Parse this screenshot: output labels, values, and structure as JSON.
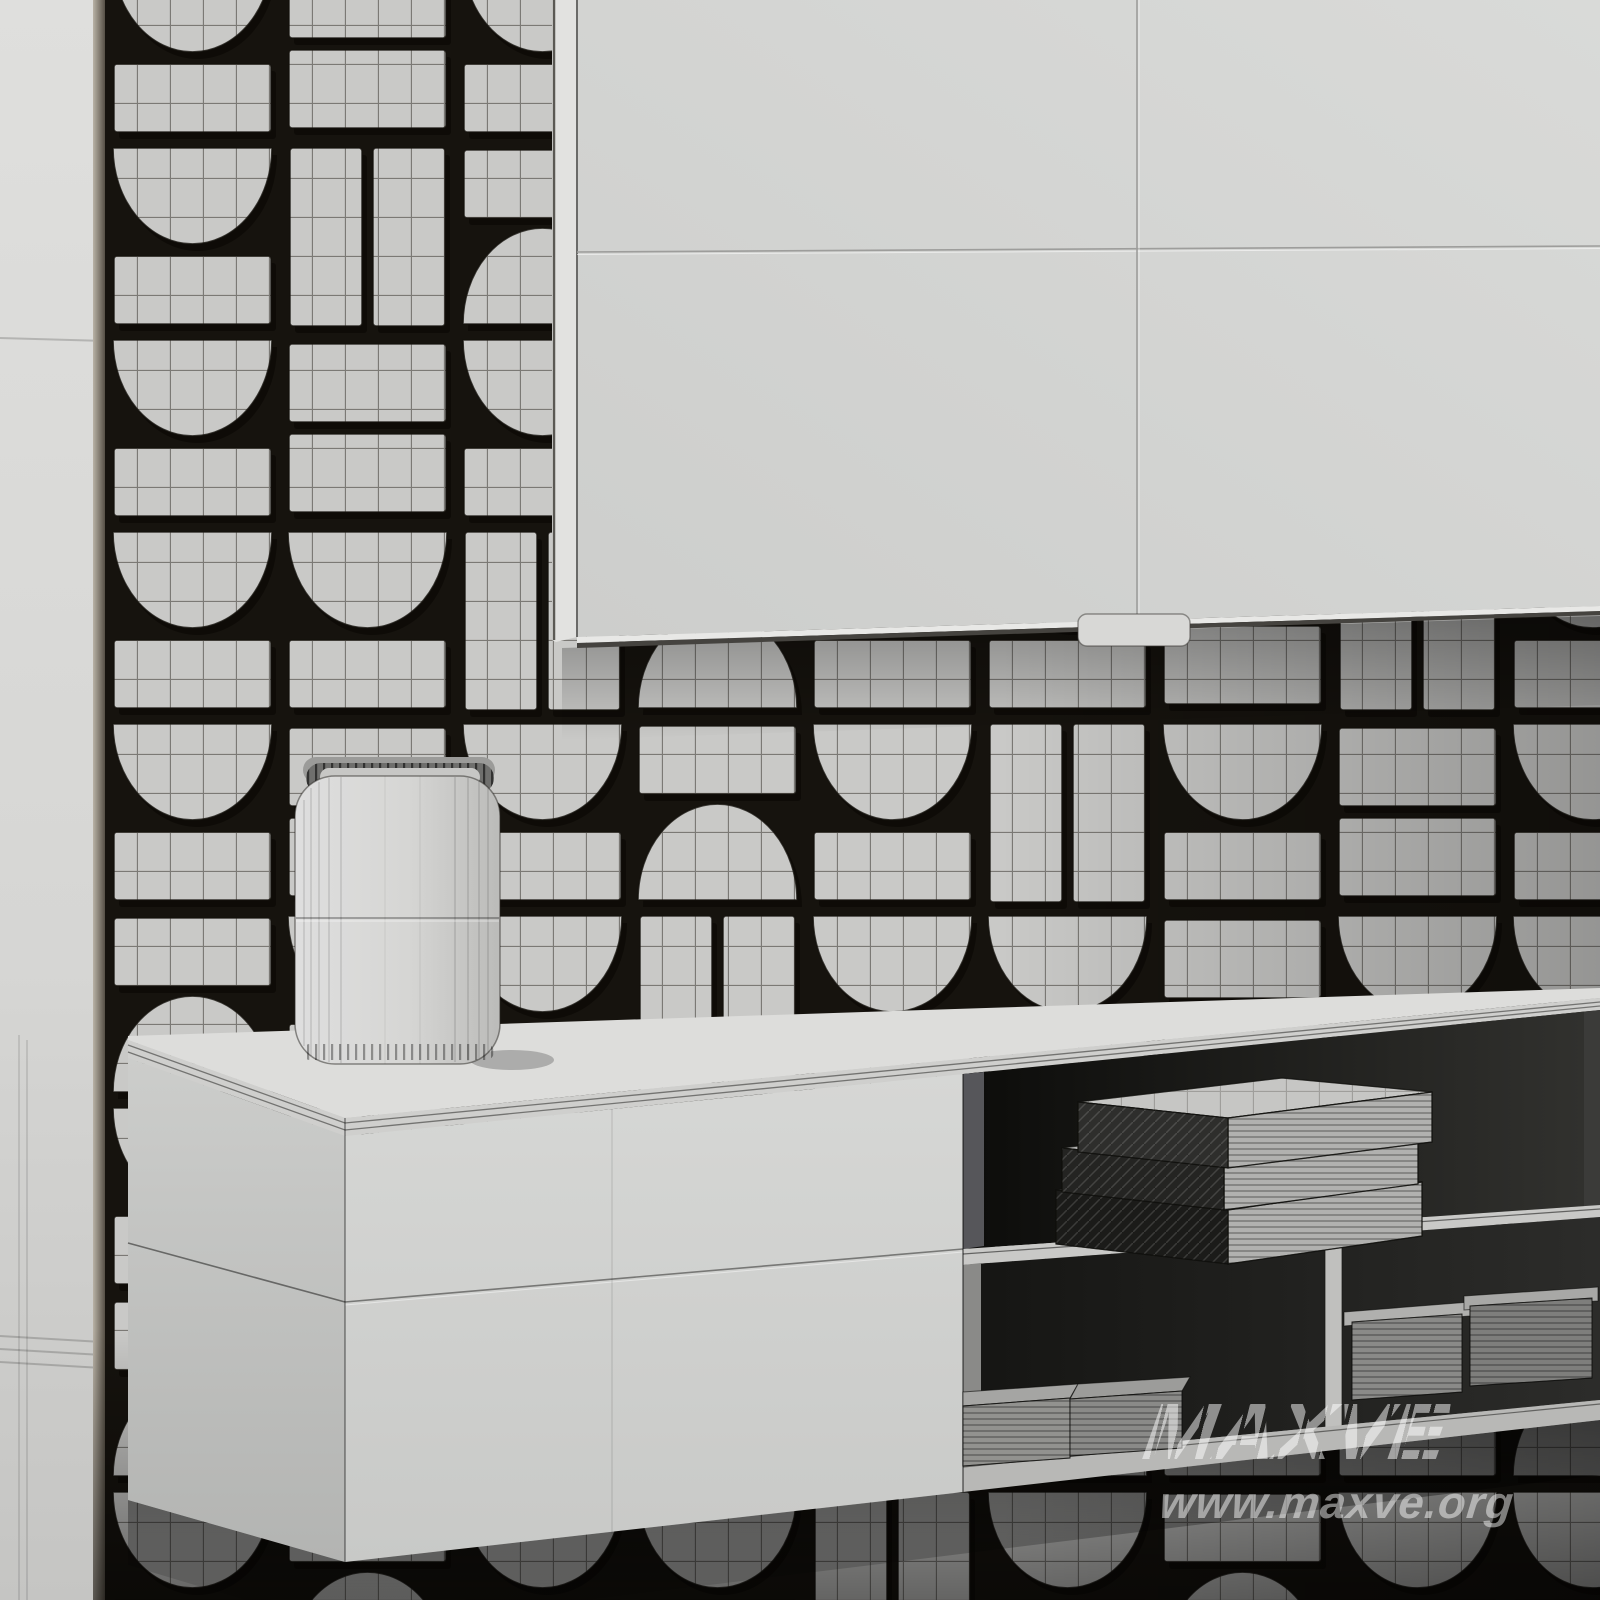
{
  "watermark": {
    "brand_text": "MAXVE",
    "site_text": "www.maxve.org",
    "color": "rgba(255,255,255,0.50)",
    "site_color": "rgba(255,255,255,0.48)"
  },
  "scene": {
    "description": "grayscale 3d wireframe clay render",
    "objects": [
      "patterned-3d-tile-wall",
      "flat-tv-panel",
      "floating-media-console",
      "drawer-fronts",
      "open-shelves",
      "book-stack",
      "magazine-piles",
      "decor-box"
    ]
  },
  "colors": {
    "wall": "#dcdcda",
    "wall_bottom": "#c6c6c4",
    "panel_gap": "#16130e",
    "tile_face": "#c9c9c7",
    "tile_shadow": "#0d0b07",
    "wire": "rgba(28,25,18,0.50)",
    "tv_face": "#d5d6d4",
    "tv_side": "#e2e2e0",
    "console_front": "#d2d3d1",
    "console_side": "#c6c7c5",
    "console_top": "#dddddb",
    "cavity": "#121210",
    "shelf": "#c9c9c7",
    "book_top": "#c6c6c4",
    "book_front": "#b1b1af",
    "book_spine": "#1b1b19",
    "magazine": "#92928f",
    "box_body": "#d9d9d7",
    "watermark": "rgba(255,255,255,0.50)"
  },
  "wall_pattern": {
    "origin_x": 105,
    "origin_y": -52,
    "cell_w": 175,
    "cell_h": 192,
    "rows": [
      [
        "A",
        "R",
        "A",
        "P",
        "A",
        "R",
        "A",
        "P",
        "A"
      ],
      [
        "A",
        "P",
        "B",
        "A",
        "A",
        "R",
        "A",
        "A",
        "P"
      ],
      [
        "A",
        "R",
        "A",
        "A",
        "P",
        "A",
        "B",
        "A",
        "A"
      ],
      [
        "A",
        "A",
        "P",
        "B",
        "A",
        "A",
        "R",
        "P",
        "A"
      ],
      [
        "A",
        "R",
        "A",
        "B",
        "A",
        "P",
        "A",
        "R",
        "A"
      ],
      [
        "B",
        "A",
        "A",
        "P",
        "A",
        "A",
        "R",
        "A",
        "A"
      ],
      [
        "A",
        "P",
        "R",
        "A",
        "A",
        "B",
        "P",
        "A",
        "A"
      ],
      [
        "B",
        "A",
        "B",
        "R",
        "A",
        "B",
        "A",
        "A",
        "B"
      ],
      [
        "A",
        "B",
        "A",
        "A",
        "P",
        "A",
        "B",
        "A",
        "A"
      ]
    ]
  }
}
